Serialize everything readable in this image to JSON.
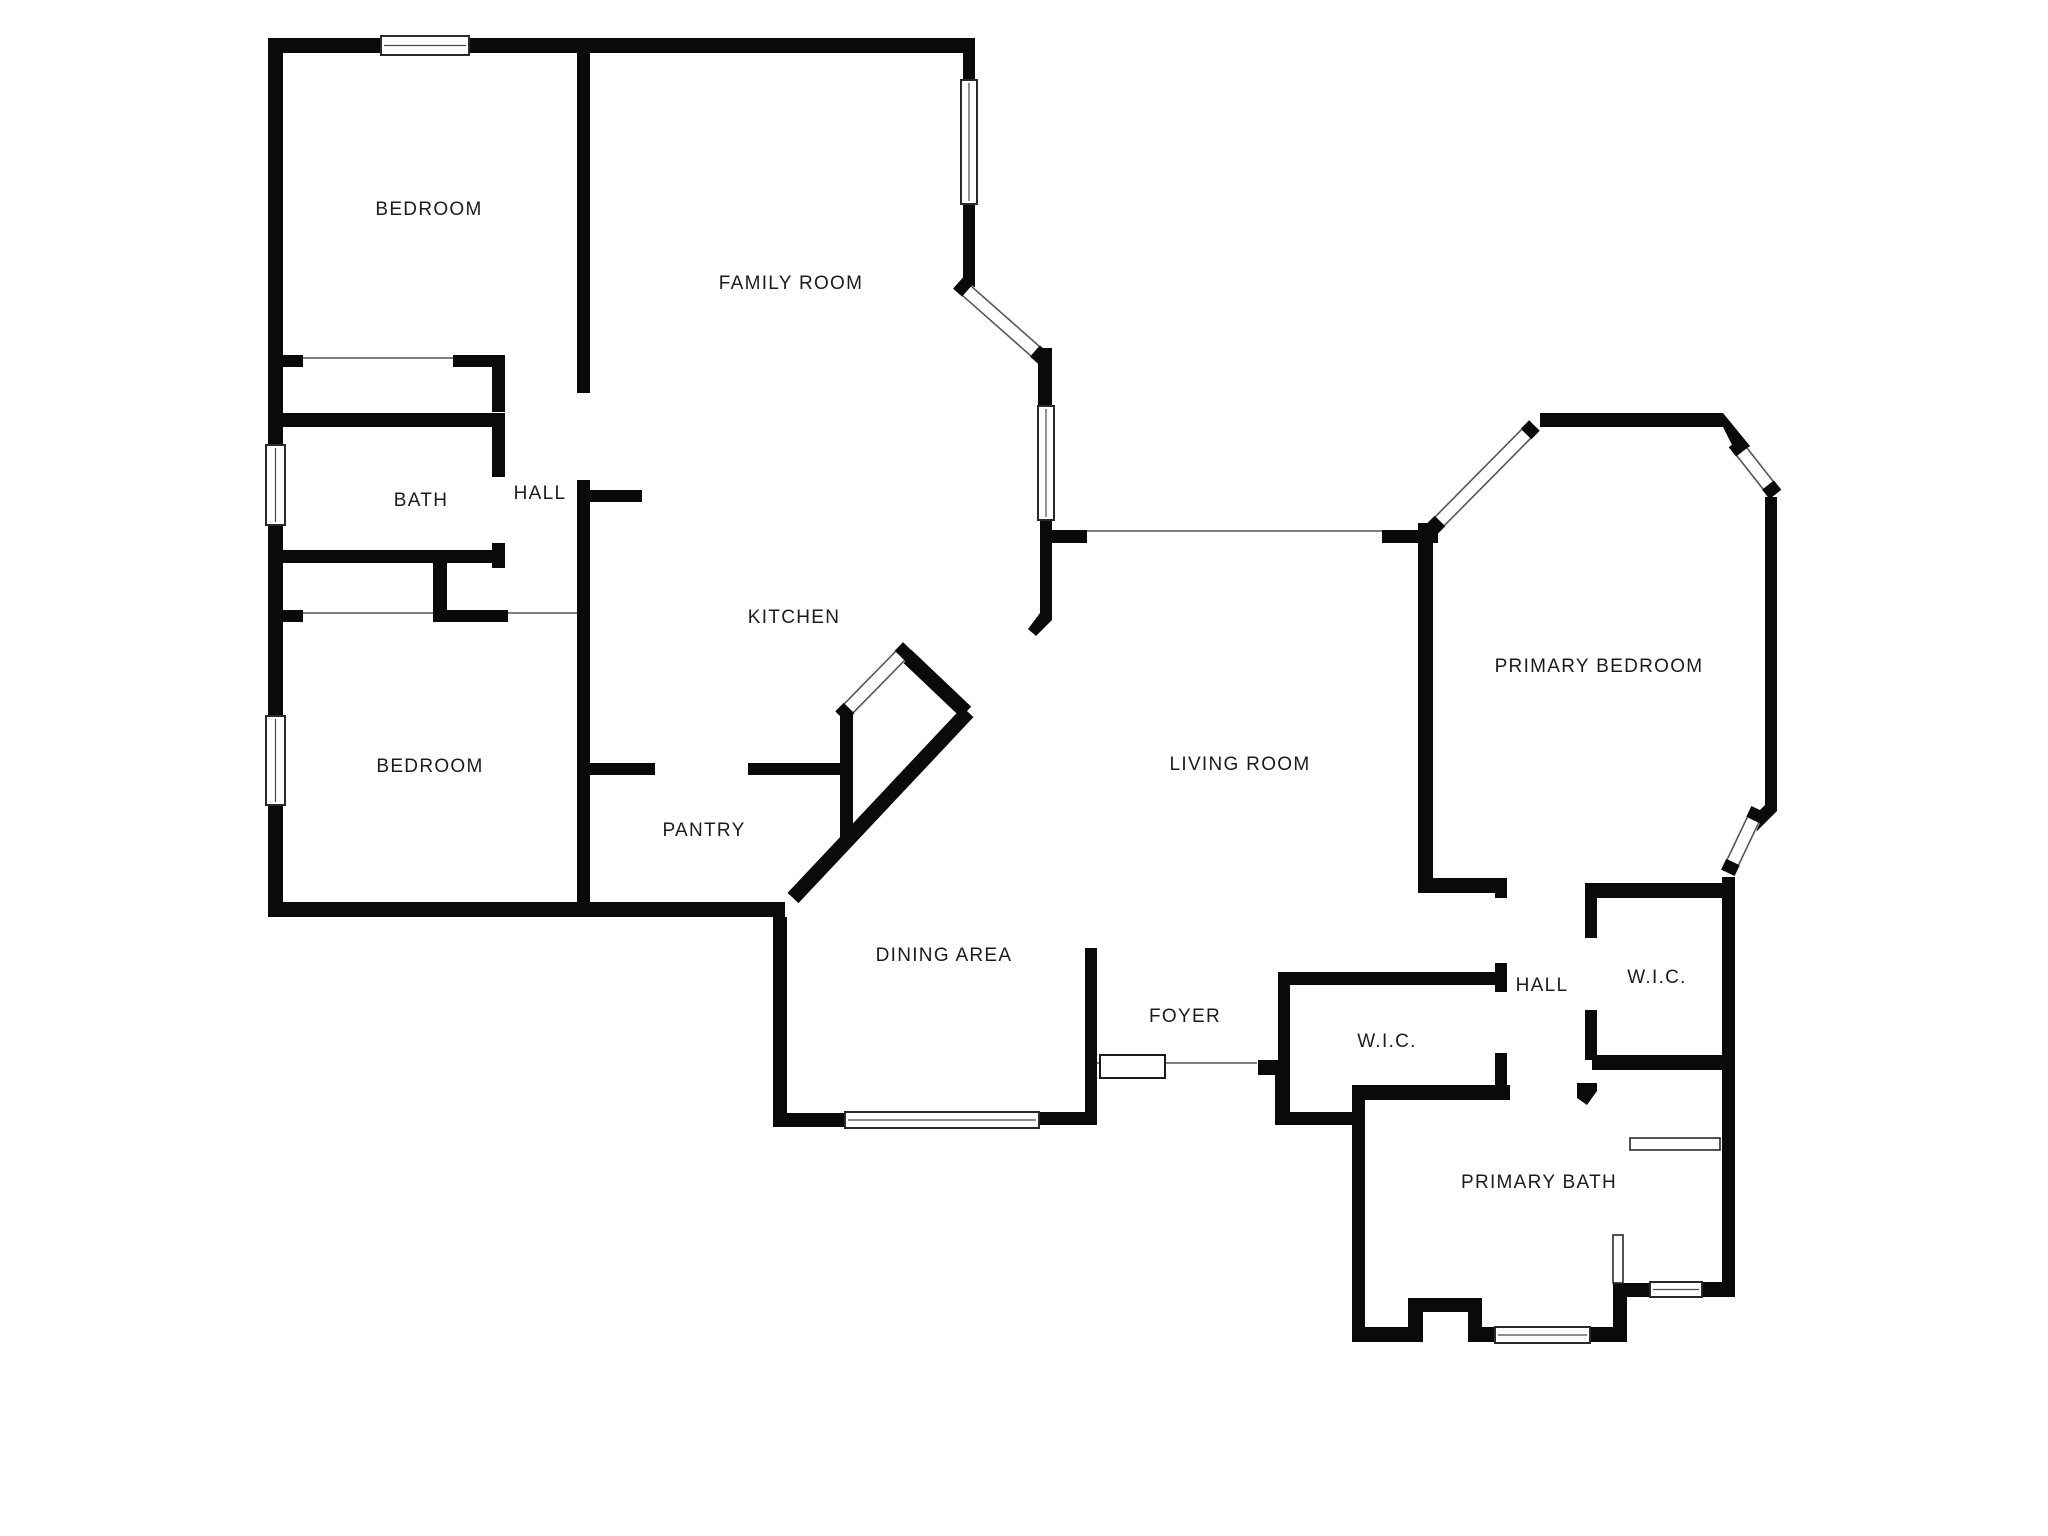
{
  "title": "Floor plan",
  "colors": {
    "wall": "#0a0a0a",
    "background": "#ffffff",
    "text": "#1c1c1c",
    "window_edge": "#4a4a4a",
    "threshold_line": "#555555"
  },
  "rooms": [
    {
      "id": "bedroom-1",
      "label": "BEDROOM"
    },
    {
      "id": "family-room",
      "label": "FAMILY ROOM"
    },
    {
      "id": "bath",
      "label": "BATH"
    },
    {
      "id": "hall-left",
      "label": "HALL"
    },
    {
      "id": "kitchen",
      "label": "KITCHEN"
    },
    {
      "id": "bedroom-2",
      "label": "BEDROOM"
    },
    {
      "id": "pantry",
      "label": "PANTRY"
    },
    {
      "id": "dining-area",
      "label": "DINING AREA"
    },
    {
      "id": "living-room",
      "label": "LIVING ROOM"
    },
    {
      "id": "primary-bedroom",
      "label": "PRIMARY BEDROOM"
    },
    {
      "id": "foyer",
      "label": "FOYER"
    },
    {
      "id": "wic-left",
      "label": "W.I.C."
    },
    {
      "id": "hall-right",
      "label": "HALL"
    },
    {
      "id": "wic-right",
      "label": "W.I.C."
    },
    {
      "id": "primary-bath",
      "label": "PRIMARY BATH"
    }
  ]
}
